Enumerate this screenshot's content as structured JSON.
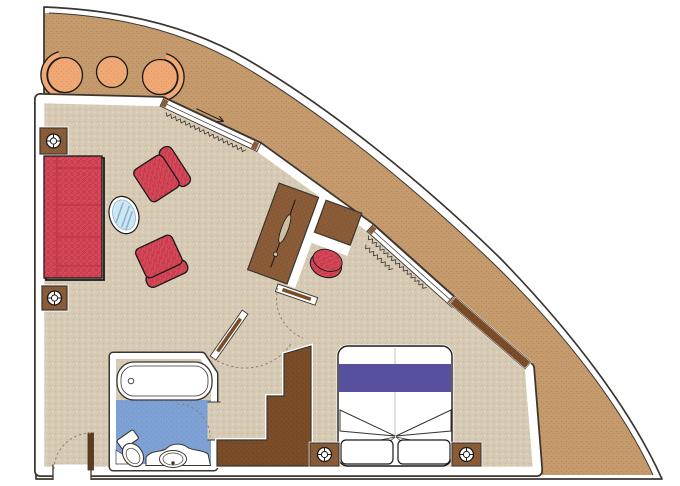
{
  "document": {
    "kind": "floor-plan",
    "description": "cruise ship suite cabin floor plan with curved hull balcony"
  },
  "colors": {
    "background": "#ffffff",
    "outline": "#1a1a1a",
    "wall_line": "#3b3530",
    "hull_tan": "#c59a6c",
    "hull_tan_dot": "#b3865a",
    "floor_beige": "#d7cab4",
    "floor_dot": "#c4b59b",
    "bath_blue": "#7fa2d6",
    "bath_blue_dot": "#6e92c4",
    "furniture_red": "#d8495a",
    "furniture_red_dark": "#b53343",
    "wood": "#8a5c38",
    "wood_dot": "#7a4d2b",
    "wood_dark": "#7b4c28",
    "wood_dark_dot": "#6a3d1d",
    "entry_door": "#5f3c20",
    "balcony_chair": "#f0a874",
    "balcony_chair_dot": "#e2935c",
    "bed_stripe": "#56509e",
    "glass": "#cfe6f4",
    "glass_stripe": "#8fb4d2",
    "lamp_lens": "#cdbfa6",
    "dash": "#8c8274",
    "white": "#ffffff"
  },
  "rooms": {
    "balcony": {
      "furniture": [
        "barrel-chair",
        "round-table",
        "barrel-chair"
      ]
    },
    "living_room": {
      "furniture": [
        "corner-table",
        "sofa-three-seat",
        "armchair",
        "armchair",
        "oval-glass-table",
        "corner-table"
      ]
    },
    "desk_area": {
      "furniture": [
        "desk-cabinet",
        "desk-lamp",
        "side-cabinet",
        "stool"
      ]
    },
    "bathroom": {
      "furniture": [
        "bathtub",
        "toilet",
        "washbasin"
      ]
    },
    "bedroom": {
      "furniture": [
        "double-bed",
        "pillow",
        "pillow",
        "nightstand",
        "nightstand",
        "wardrobe",
        "window-sill"
      ]
    }
  },
  "features": [
    "hull-curve",
    "balcony-sliding-door",
    "bedroom-sliding-door",
    "curtains",
    "entry-door",
    "bathroom-door",
    "interior-door",
    "door-swing-arcs"
  ]
}
